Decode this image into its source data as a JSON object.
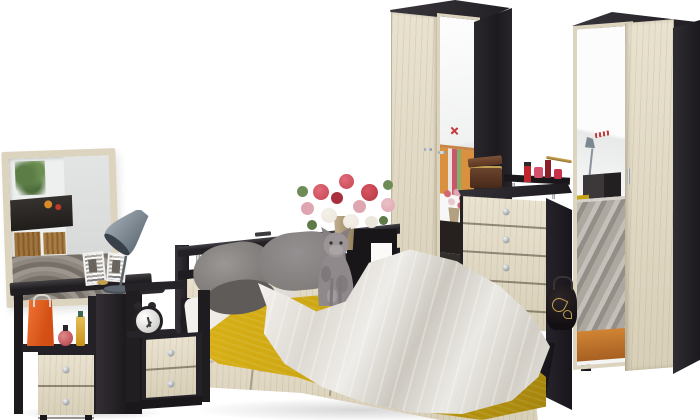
{
  "scene": {
    "type": "product-photo-render",
    "subject": "bedroom-furniture-set",
    "background": "white-seamless",
    "objects": [
      "wall-mirror",
      "dressing-table",
      "table-lamp",
      "gift-bag",
      "perfume-bottles",
      "drawer-pedestal",
      "bedside-cabinet",
      "alarm-clock",
      "double-bed-with-storage-drawers",
      "headboard-shelf-unit",
      "pillows",
      "mustard-bedspread",
      "white-throw-blanket",
      "cat",
      "bouquet-in-vase",
      "mirrored-wardrobe-left",
      "chest-of-drawers",
      "jewelry-box",
      "cosmetics-shelf",
      "handbag",
      "mirrored-wardrobe-right"
    ]
  },
  "palette": {
    "bg": "#ffffff",
    "wenge": "#242127",
    "wenge_light": "#3b383c",
    "wenge_dark": "#17141a",
    "oak": "#e9e2cf",
    "oak_shade": "#d8cfb8",
    "mirror_frame": "#ddd4bf",
    "glass": "#eef0ef",
    "chrome": "#c5c9cc",
    "mustard": "#c7a212",
    "mustard_dark": "#a5850c",
    "pillow": "#8e8b88",
    "pillow_dark": "#69615f",
    "throw": "#e9e6e0",
    "throw_shade": "#ccc8c0",
    "sheet": "#f6f4f0",
    "orange": "#e9602a",
    "lamp": "#7c8990",
    "cat": "#958f91",
    "flower_red": "#c64553",
    "flower_pink": "#dfa6b1",
    "flower_white": "#ece7dd",
    "leaf": "#6f8c58",
    "vase": "#b2a07e",
    "wood": "#c1752e",
    "box_brown": "#6b422b",
    "gold": "#c2a052",
    "cosmetic_red": "#b2242f"
  }
}
